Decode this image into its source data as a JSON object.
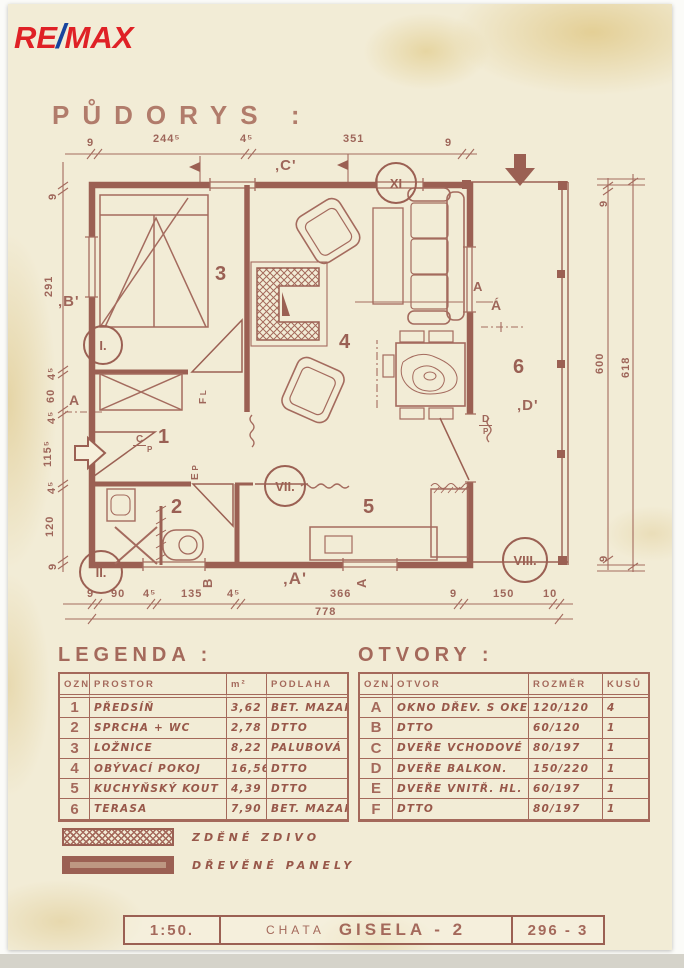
{
  "logo": {
    "re": "RE",
    "slash": "/",
    "max": "MAX"
  },
  "title": "PŮDORYS :",
  "plan": {
    "dims": {
      "top": [
        "9",
        "244⁵",
        "4⁵",
        "351",
        "9"
      ],
      "left": [
        "9",
        "291",
        "4⁵",
        "60",
        "4⁵",
        "115⁵",
        "4⁵",
        "120",
        "9"
      ],
      "bottom": [
        "9",
        "90",
        "4⁵",
        "135",
        "4⁵",
        "366",
        "9",
        "150",
        "10"
      ],
      "bottom_total": "778",
      "right": [
        "9",
        "600",
        "9"
      ],
      "right_total": "618"
    },
    "markers": {
      "b": "‚B'",
      "c": "‚C'",
      "a": "‚A'",
      "d": "‚D'",
      "a_acute": "Á",
      "section_a_right": "A",
      "section_a_left": "A",
      "section_b_bottom": "B",
      "section_a_bottom": "A"
    },
    "detail_circles": {
      "i": "I.",
      "ii": "II.",
      "vii": "VII.",
      "viii": "VIII.",
      "xi": "XI"
    },
    "rooms": {
      "r1": "1",
      "r2": "2",
      "r3": "3",
      "r4": "4",
      "r5": "5",
      "r6": "6"
    },
    "door_labels": {
      "c": "C",
      "c_sub": "P",
      "d": "D",
      "d_sub": "P",
      "e": "E",
      "e_sub": "P",
      "f": "F",
      "f_sub": "L"
    }
  },
  "legend": {
    "title": "LEGENDA :",
    "headers": [
      "OZN.",
      "PROSTOR",
      "m²",
      "PODLAHA"
    ],
    "rows": [
      [
        "1",
        "PŘEDSÍŇ",
        "3,62",
        "BET. MAZAN."
      ],
      [
        "2",
        "SPRCHA + WC",
        "2,78",
        "DTTO"
      ],
      [
        "3",
        "LOŽNICE",
        "8,22",
        "PALUBOVÁ"
      ],
      [
        "4",
        "OBÝVACÍ POKOJ",
        "16,56",
        "DTTO"
      ],
      [
        "5",
        "KUCHYŇSKÝ KOUT",
        "4,39",
        "DTTO"
      ],
      [
        "6",
        "TERASA",
        "7,90",
        "BET. MAZAN."
      ]
    ],
    "hatch_items": [
      {
        "label": "ZDĚNÉ ZDIVO"
      },
      {
        "label": "DŘEVĚNÉ PANELY"
      }
    ]
  },
  "openings": {
    "title": "OTVORY :",
    "headers": [
      "OZN.",
      "OTVOR",
      "ROZMĚR",
      "KUSŮ"
    ],
    "rows": [
      [
        "A",
        "OKNO DŘEV. S OKEN.",
        "120/120",
        "4"
      ],
      [
        "B",
        "DTTO",
        "60/120",
        "1"
      ],
      [
        "C",
        "DVEŘE VCHODOVÉ",
        "80/197",
        "1"
      ],
      [
        "D",
        "DVEŘE BALKON.",
        "150/220",
        "1"
      ],
      [
        "E",
        "DVEŘE VNITŘ. HL.",
        "60/197",
        "1"
      ],
      [
        "F",
        "DTTO",
        "80/197",
        "1"
      ]
    ]
  },
  "titleblock": {
    "scale": "1:50.",
    "project": "CHATA",
    "name": "GISELA - 2",
    "number": "296 - 3"
  },
  "colors": {
    "ink": "#9b6053",
    "paper": "#f2ecd6",
    "logo_red": "#df2126",
    "logo_blue": "#17449e"
  }
}
